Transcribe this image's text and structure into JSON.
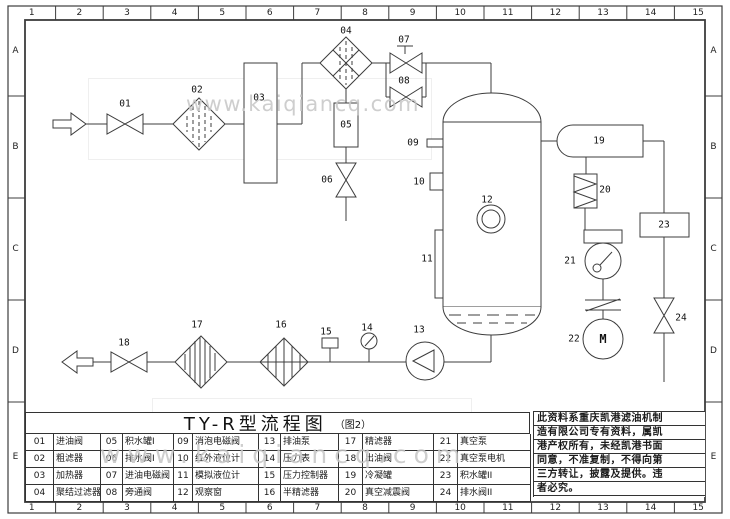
{
  "title": {
    "main": "TY-R型流程图",
    "suffix": "（图2）"
  },
  "watermark": {
    "text": "www.kaiqiancq.com"
  },
  "grid": {
    "cols": [
      "1",
      "2",
      "3",
      "4",
      "5",
      "6",
      "7",
      "8",
      "9",
      "10",
      "11",
      "12",
      "13",
      "14",
      "15"
    ],
    "rows": [
      "A",
      "B",
      "C",
      "D",
      "E"
    ]
  },
  "parts": [
    {
      "no": "01",
      "name": "进油阀"
    },
    {
      "no": "02",
      "name": "粗滤器"
    },
    {
      "no": "03",
      "name": "加热器"
    },
    {
      "no": "04",
      "name": "聚结过滤器"
    },
    {
      "no": "05",
      "name": "积水罐I"
    },
    {
      "no": "06",
      "name": "排水阀I"
    },
    {
      "no": "07",
      "name": "进油电磁阀"
    },
    {
      "no": "08",
      "name": "旁通阀"
    },
    {
      "no": "09",
      "name": "消泡电磁阀"
    },
    {
      "no": "10",
      "name": "红外液位计"
    },
    {
      "no": "11",
      "name": "模拟液位计"
    },
    {
      "no": "12",
      "name": "观察窗"
    },
    {
      "no": "13",
      "name": "排油泵"
    },
    {
      "no": "14",
      "name": "压力表"
    },
    {
      "no": "15",
      "name": "压力控制器"
    },
    {
      "no": "16",
      "name": "半精滤器"
    },
    {
      "no": "17",
      "name": "精滤器"
    },
    {
      "no": "18",
      "name": "出油阀"
    },
    {
      "no": "19",
      "name": "冷凝罐"
    },
    {
      "no": "20",
      "name": "真空减震阀"
    },
    {
      "no": "21",
      "name": "真空泵"
    },
    {
      "no": "22",
      "name": "真空泵电机"
    },
    {
      "no": "23",
      "name": "积水罐II"
    },
    {
      "no": "24",
      "name": "排水阀II"
    }
  ],
  "notes": {
    "lines": [
      "此资料系重庆凯港滤油机制",
      "造有限公司专有资料，属凯",
      "港产权所有，未经凯港书面",
      "同意，不准复制，不得向第",
      "三方转让，披露及提供。违",
      "者必究。"
    ]
  },
  "diagram": {
    "motor_letter": "M"
  },
  "colors": {
    "line": "#3c3c3c",
    "watermark": "#c6c6c6",
    "paper": "#ffffff"
  }
}
